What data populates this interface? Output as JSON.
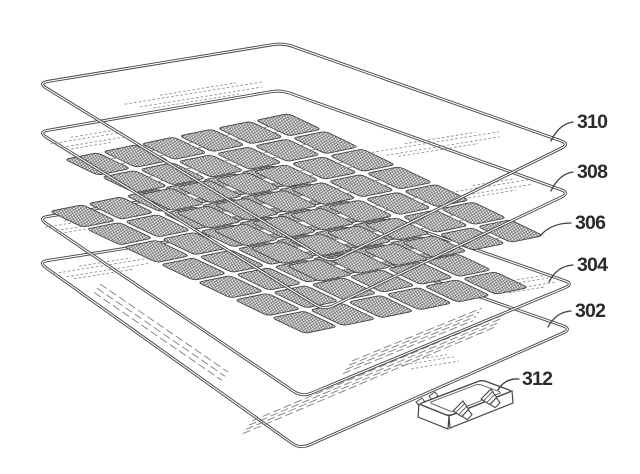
{
  "figure": {
    "background_color": "#ffffff",
    "line_color": "#454545",
    "hatch_color": "#555555",
    "label_color": "#2b2b2b",
    "reference_labels": {
      "label_310": "310",
      "label_308": "308",
      "label_306": "306",
      "label_304": "304",
      "label_302": "302",
      "label_312": "312"
    },
    "cell_array": {
      "rows": 6,
      "cols": 7
    }
  }
}
